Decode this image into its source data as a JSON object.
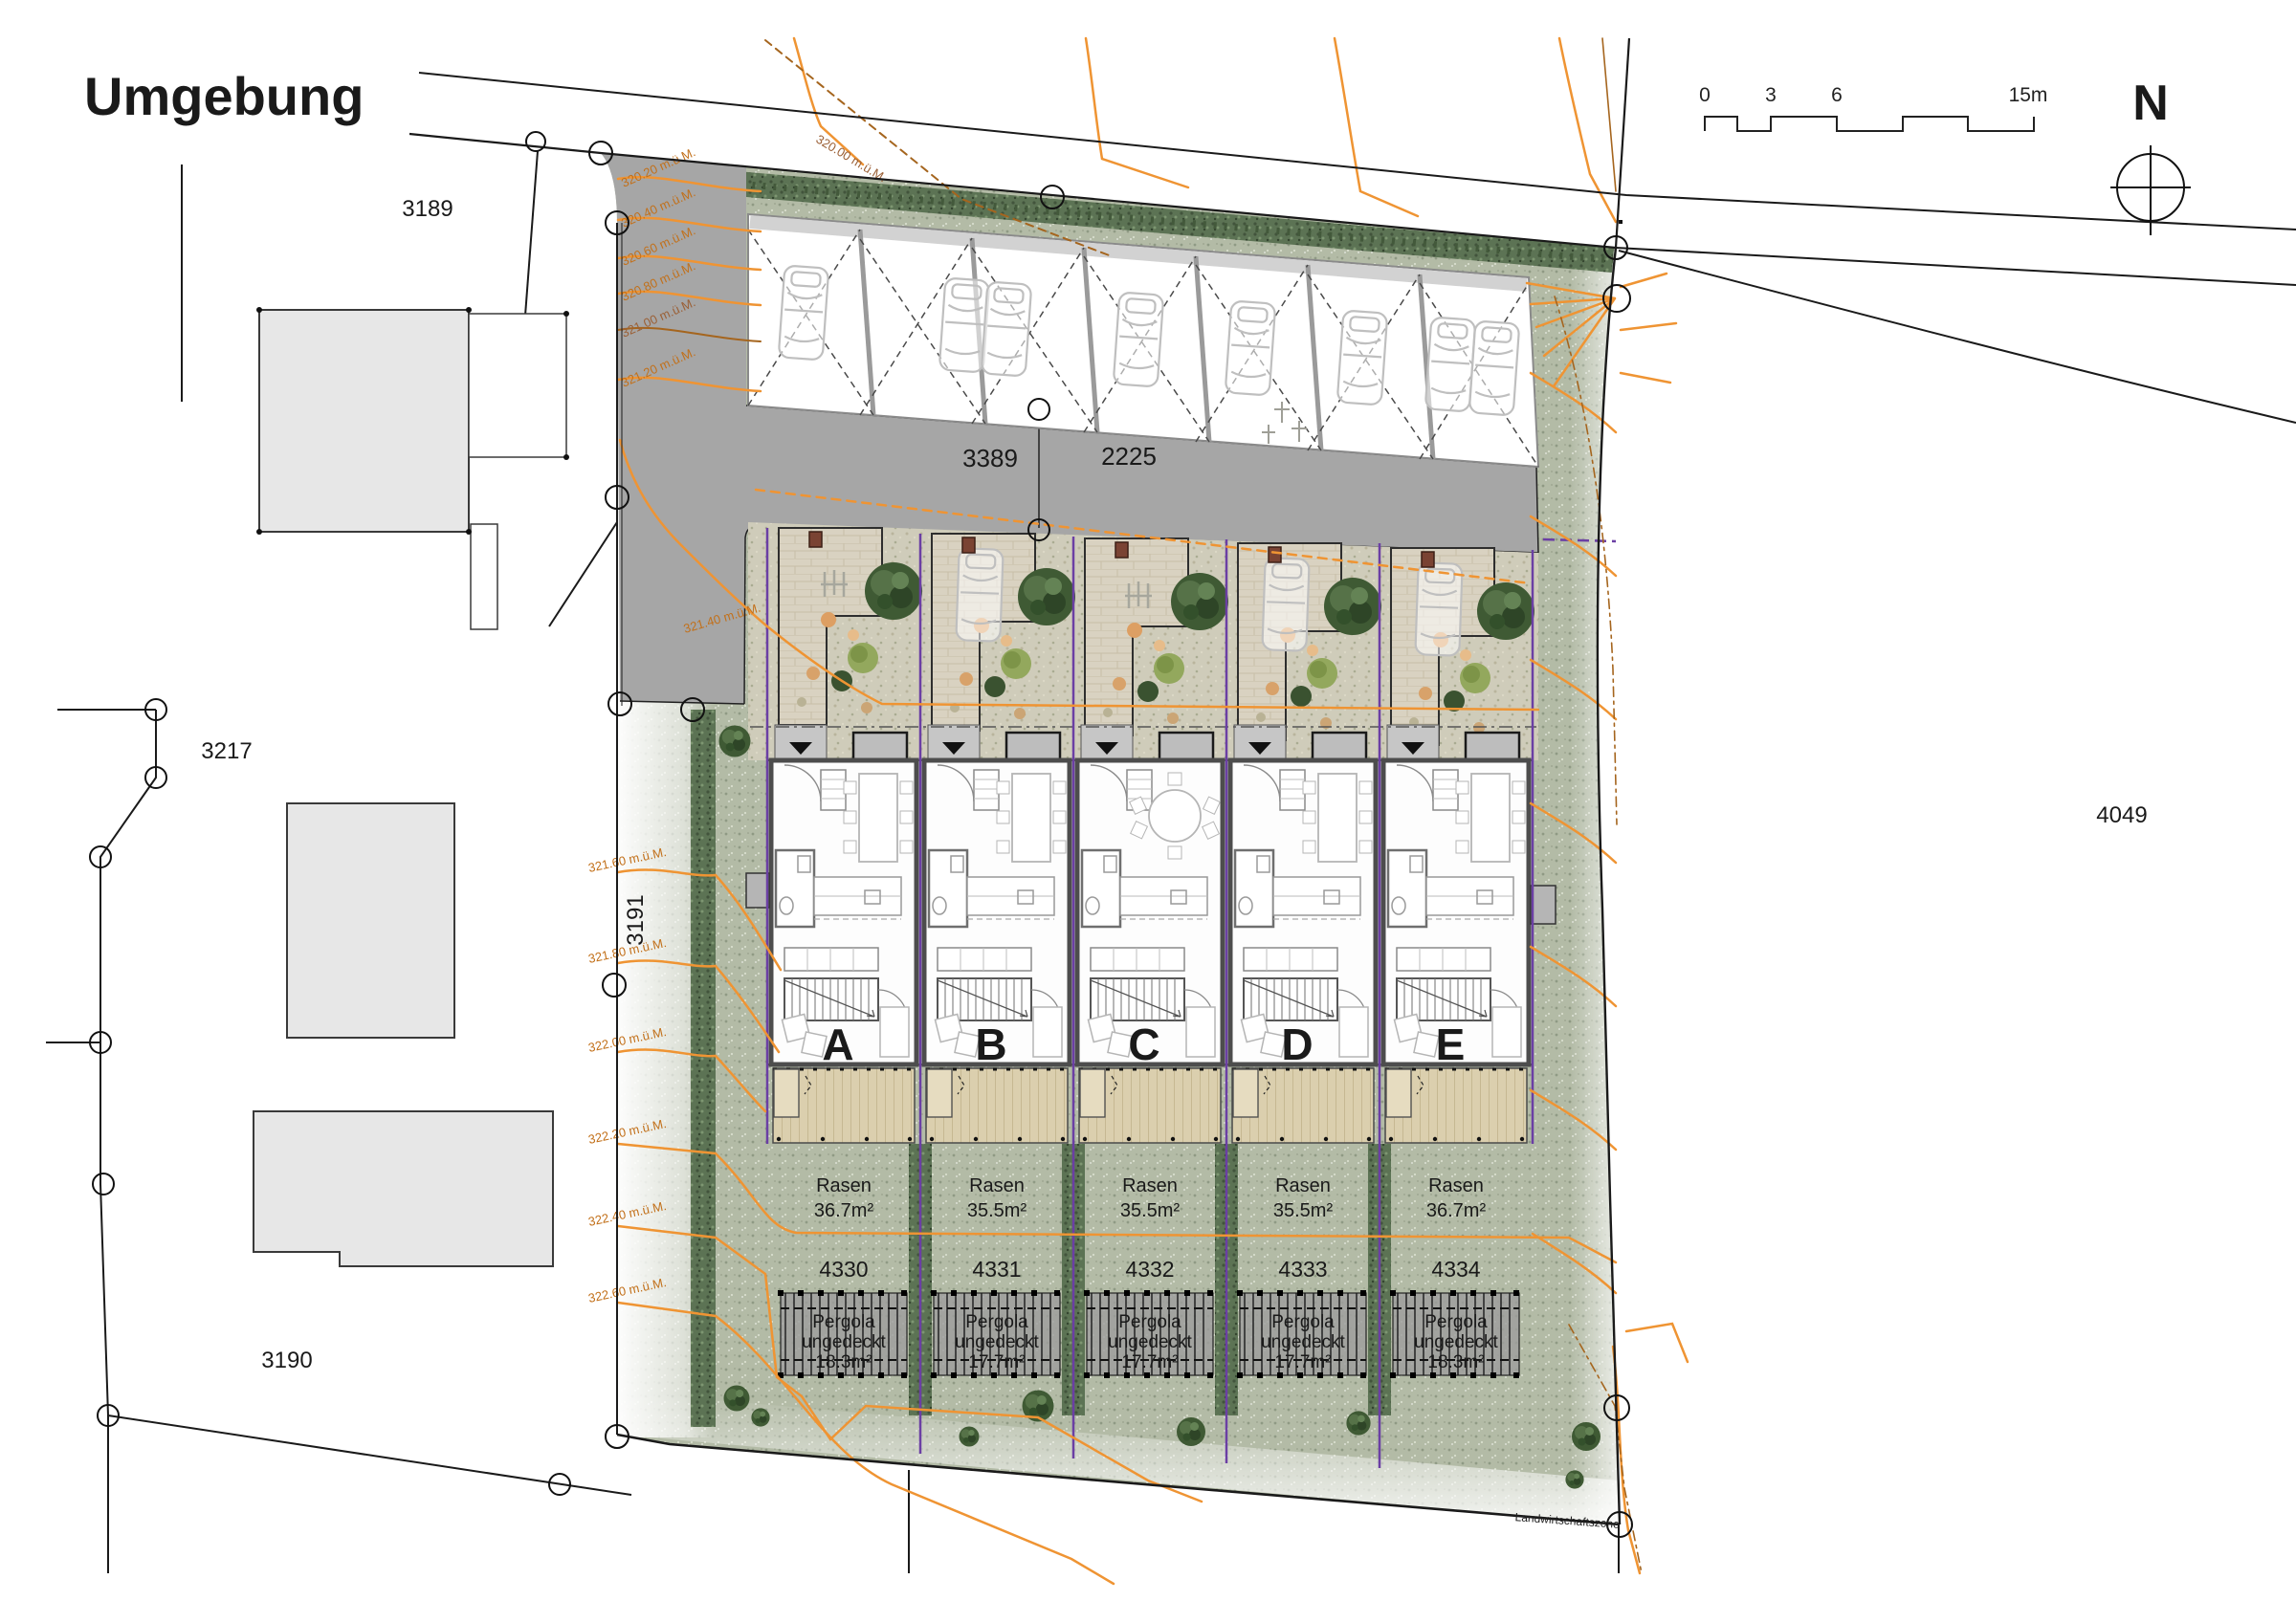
{
  "title": "Umgebung",
  "north": "N",
  "scale": [
    "0",
    "3",
    "6",
    "15m"
  ],
  "zone": "Landwirtschaftszone",
  "parcels": {
    "p3189": "3189",
    "p3217": "3217",
    "p3190": "3190",
    "p3191": "3191",
    "p4049": "4049"
  },
  "roads": {
    "r1": "3389",
    "r2": "2225"
  },
  "houses": [
    {
      "letter": "A",
      "rasen": "Rasen",
      "area": "36.7m²",
      "lot": "4330",
      "pergola1": "Pergola",
      "pergola2": "ungedeckt",
      "pergola3": "18.3m²"
    },
    {
      "letter": "B",
      "rasen": "Rasen",
      "area": "35.5m²",
      "lot": "4331",
      "pergola1": "Pergola",
      "pergola2": "ungedeckt",
      "pergola3": "17.7m²"
    },
    {
      "letter": "C",
      "rasen": "Rasen",
      "area": "35.5m²",
      "lot": "4332",
      "pergola1": "Pergola",
      "pergola2": "ungedeckt",
      "pergola3": "17.7m²"
    },
    {
      "letter": "D",
      "rasen": "Rasen",
      "area": "35.5m²",
      "lot": "4333",
      "pergola1": "Pergola",
      "pergola2": "ungedeckt",
      "pergola3": "17.7m²"
    },
    {
      "letter": "E",
      "rasen": "Rasen",
      "area": "36.7m²",
      "lot": "4334",
      "pergola1": "Pergola",
      "pergola2": "ungedeckt",
      "pergola3": "18.3m²"
    }
  ],
  "contours": {
    "street": "320.00 m.ü.M.",
    "driveway": [
      "320.20 m.ü.M.",
      "320.40 m.ü.M.",
      "320.60 m.ü.M.",
      "320.80 m.ü.M.",
      "321.00 m.ü.M.",
      "321.20 m.ü.M.",
      "321.40 m.ü.M."
    ],
    "west": [
      "321.60 m.ü.M.",
      "321.80 m.ü.M.",
      "322.00 m.ü.M.",
      "322.20 m.ü.M.",
      "322.40 m.ü.M.",
      "322.60 m.ü.M."
    ]
  },
  "counts": {
    "parking_stalls": 7,
    "parked_cars": 8,
    "row_houses": 5
  },
  "colors": {
    "contour_orange": "#EF9433",
    "contour_brown": "#A5651E",
    "boundary_black": "#1A1A1A",
    "lawn_green": "#B3BBA6",
    "hedge_green": "#5C7354",
    "road_gray": "#A6A6A6",
    "paving_beige": "#D9D2C1",
    "terrace_tan": "#DBCFAE",
    "lot_line_purple": "#6B3FA4",
    "building_gray": "#E7E7E7"
  }
}
